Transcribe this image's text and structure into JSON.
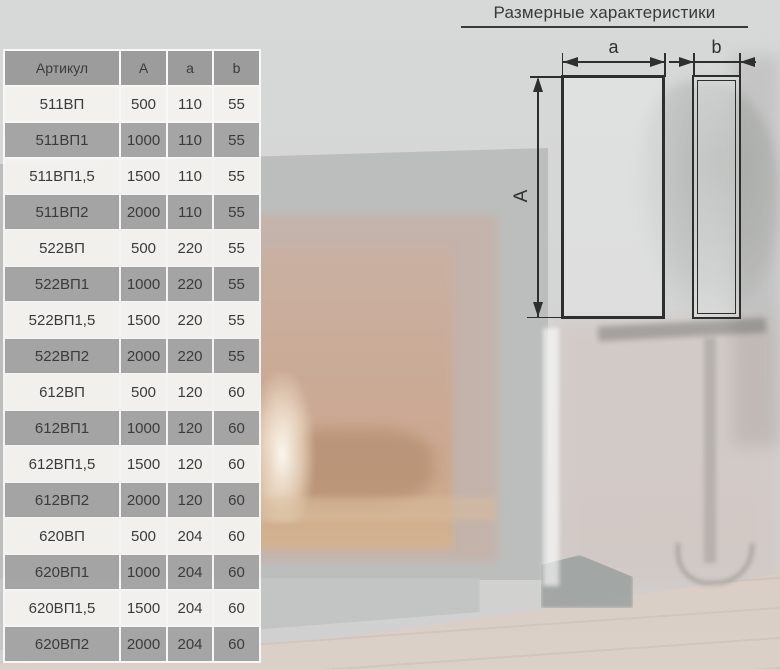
{
  "section": {
    "title": "Размерные характеристики"
  },
  "table": {
    "columns": [
      "Артикул",
      "A",
      "a",
      "b"
    ],
    "rows": [
      [
        "511ВП",
        "500",
        "110",
        "55"
      ],
      [
        "511ВП1",
        "1000",
        "110",
        "55"
      ],
      [
        "511ВП1,5",
        "1500",
        "110",
        "55"
      ],
      [
        "511ВП2",
        "2000",
        "110",
        "55"
      ],
      [
        "522ВП",
        "500",
        "220",
        "55"
      ],
      [
        "522ВП1",
        "1000",
        "220",
        "55"
      ],
      [
        "522ВП1,5",
        "1500",
        "220",
        "55"
      ],
      [
        "522ВП2",
        "2000",
        "220",
        "55"
      ],
      [
        "612ВП",
        "500",
        "120",
        "60"
      ],
      [
        "612ВП1",
        "1000",
        "120",
        "60"
      ],
      [
        "612ВП1,5",
        "1500",
        "120",
        "60"
      ],
      [
        "612ВП2",
        "2000",
        "120",
        "60"
      ],
      [
        "620ВП",
        "500",
        "204",
        "60"
      ],
      [
        "620ВП1",
        "1000",
        "204",
        "60"
      ],
      [
        "620ВП1,5",
        "1500",
        "204",
        "60"
      ],
      [
        "620ВП2",
        "2000",
        "204",
        "60"
      ]
    ]
  },
  "diagram": {
    "label_height": "A",
    "label_width_front": "a",
    "label_width_side": "b"
  },
  "colors": {
    "line": "#2e2e2e",
    "text": "#3b3b3b",
    "header_bg": "#9b9b9b",
    "row_light": "#eceae7",
    "row_dark": "#9f9f9f",
    "title_color": "#3a3a3a"
  }
}
